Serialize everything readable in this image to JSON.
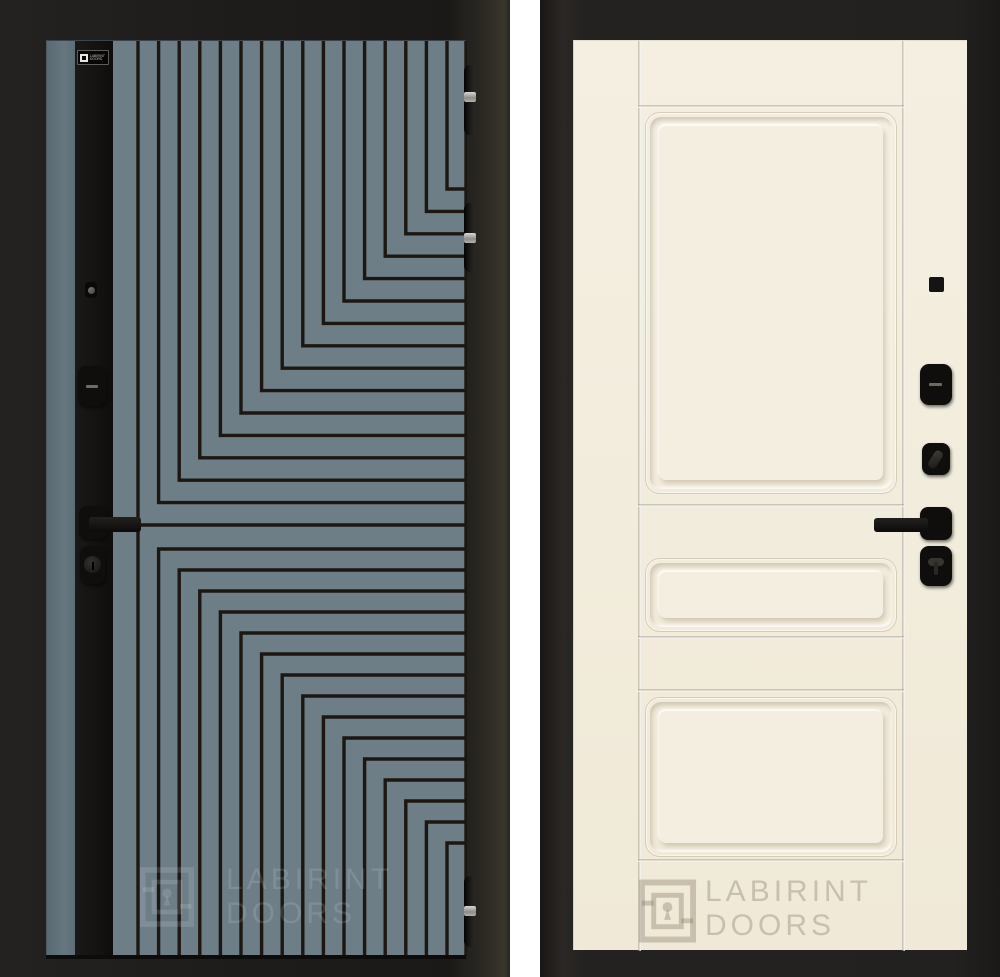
{
  "brand": {
    "badge_line1": "LABIRINT",
    "badge_line2": "DOORS",
    "watermark_line1": "LABIRINT",
    "watermark_line2": "DOORS"
  },
  "left_door": {
    "description": "entry door exterior side, black with teal labyrinth milled pattern",
    "colors": {
      "panel_teal": "#6d7e87",
      "pattern_line": "#1d1712",
      "hardware_strip": "#121110",
      "frame": "#1f1d1b",
      "hinge_band": "#b8b6b1"
    },
    "pattern": {
      "first_line_offset": 25,
      "line_spacing": 20.6,
      "line_count": 16,
      "line_width": 3.4,
      "right_edge": 353,
      "height": 915,
      "top_corner_start": 484,
      "top_corner_step": 22.4,
      "bottom_corner_start": 508,
      "bottom_corner_step": 21
    },
    "hardware": [
      "logo-badge",
      "peephole-screw",
      "smart-lock-escutcheon",
      "lever-handle",
      "keyhole-escutcheon"
    ],
    "hinge_count": 3
  },
  "right_door": {
    "description": "door interior side, cream classic three-panel design",
    "colors": {
      "leaf_cream": "#f2ecdc",
      "molding_shadow": "#897d60",
      "frame": "#23211f",
      "hardware_black": "#12110f"
    },
    "hardware": [
      "peephole",
      "lock-escutcheon",
      "key-cylinder",
      "lever-handle",
      "thumbturn"
    ]
  }
}
